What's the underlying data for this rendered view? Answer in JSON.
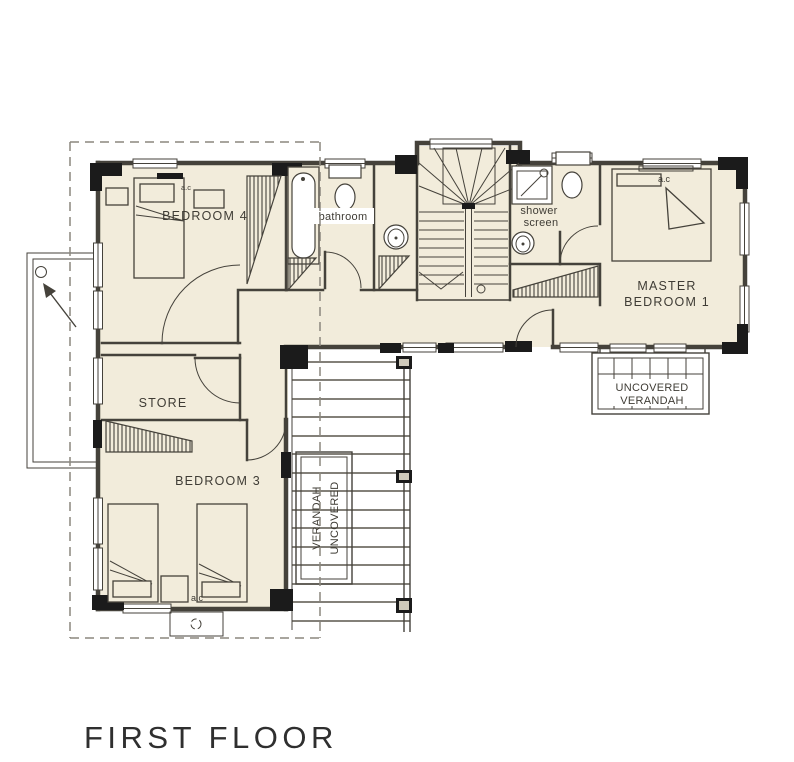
{
  "title": "FIRST FLOOR",
  "colors": {
    "floor": "#f2ecdb",
    "wall": "#1b1b1b",
    "line": "#45423b",
    "dashed": "#8b877e",
    "bg": "#ffffff",
    "text": "#3f3c35"
  },
  "rooms": {
    "bedroom4": {
      "label": "BEDROOM 4",
      "ac": "a.c"
    },
    "bathroom": {
      "label": "bathroom"
    },
    "shower": {
      "line1": "shower",
      "line2": "screen"
    },
    "master": {
      "line1": "MASTER",
      "line2": "BEDROOM 1",
      "ac": "a.c"
    },
    "store": {
      "label": "STORE"
    },
    "bedroom3": {
      "label": "BEDROOM 3",
      "ac": "a.c"
    },
    "verandah_right": {
      "line1": "UNCOVERED",
      "line2": "VERANDAH"
    },
    "verandah_bottom": {
      "line1": "VERANDAH",
      "line2": "UNCOVERED"
    }
  }
}
